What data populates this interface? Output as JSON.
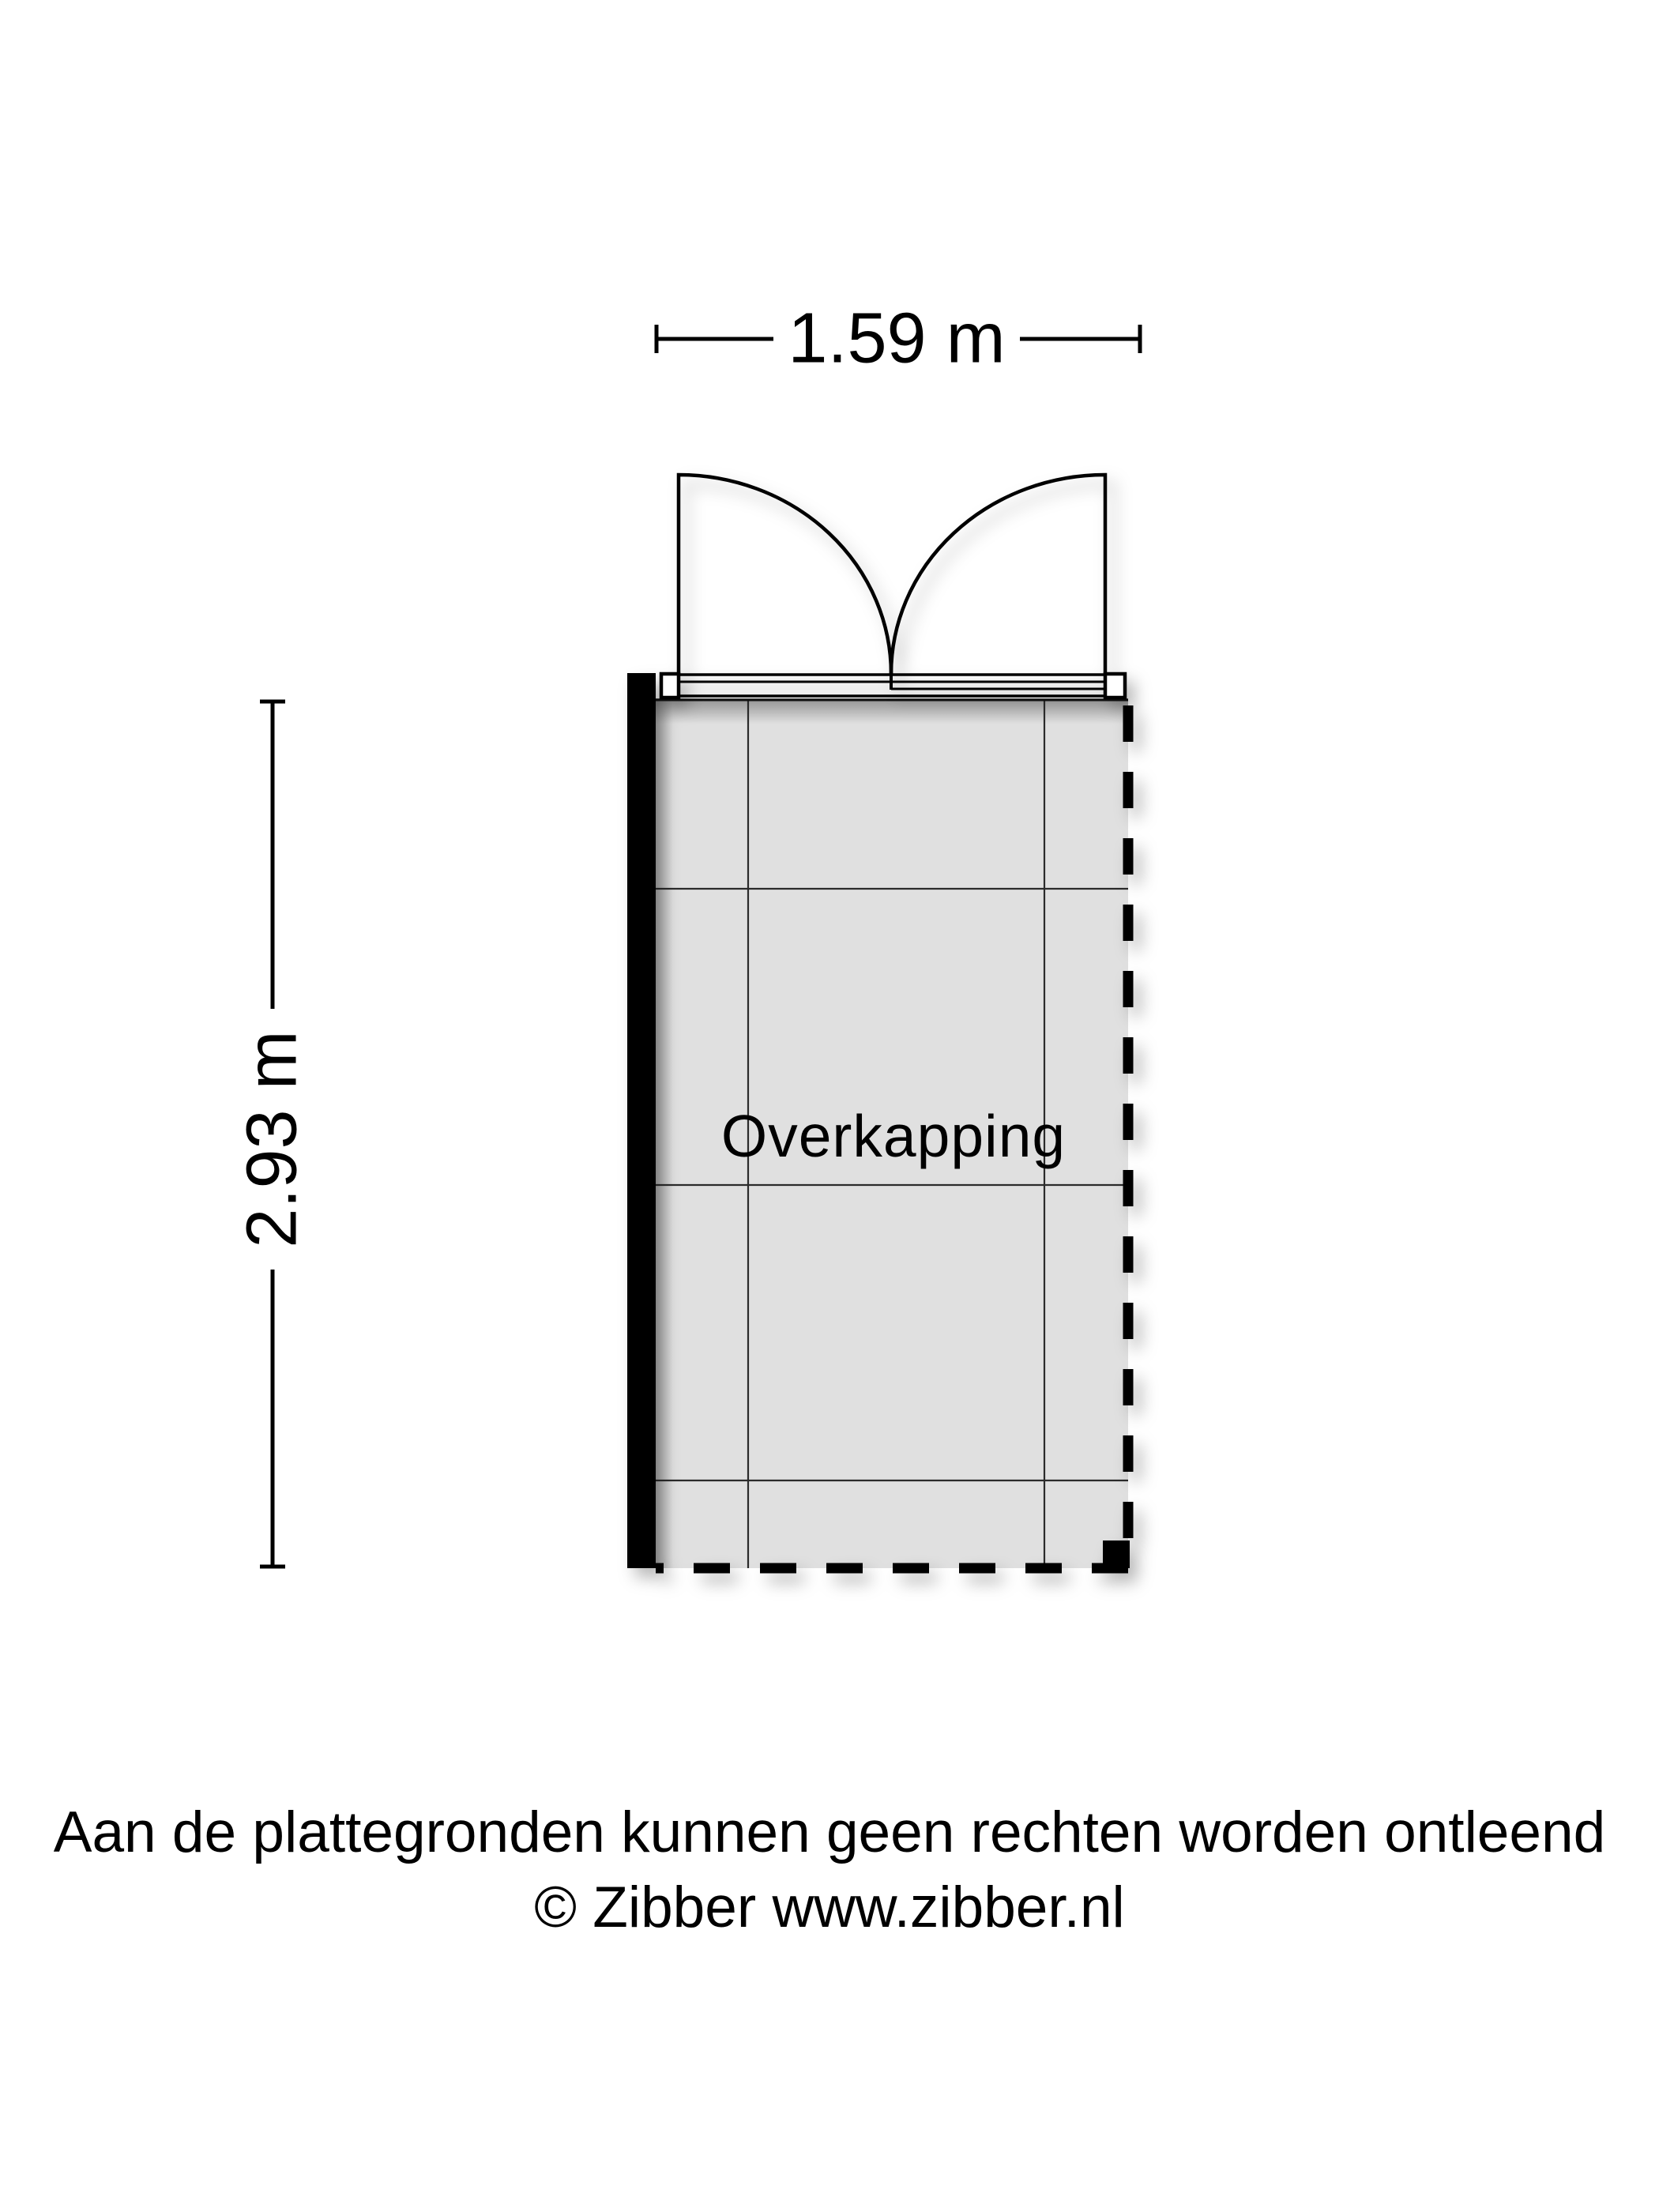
{
  "floorplan": {
    "room_label": "Overkapping",
    "width_label": "1.59 m",
    "height_label": "2.93 m"
  },
  "footer": {
    "disclaimer": "Aan de plattegronden kunnen geen rechten worden ontleend",
    "copyright": "© Zibber www.zibber.nl"
  },
  "colors": {
    "floor_fill": "#e0e0e0",
    "line_color": "#000000",
    "background": "#ffffff"
  }
}
